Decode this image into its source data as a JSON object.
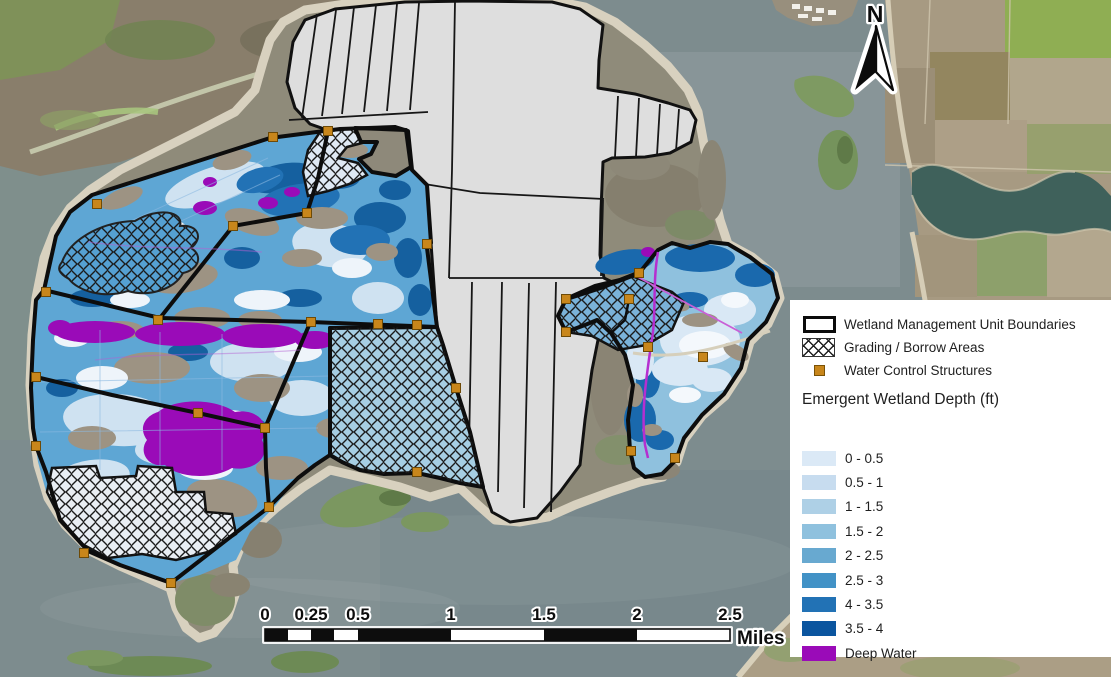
{
  "north_arrow": {
    "label": "N"
  },
  "scale_bar": {
    "tick_labels": [
      "0",
      "0.25",
      "0.5",
      "1",
      "1.5",
      "2",
      "2.5"
    ],
    "unit_label": "Miles"
  },
  "legend": {
    "items": [
      {
        "id": "boundary",
        "label": "Wetland Management Unit Boundaries"
      },
      {
        "id": "hatch",
        "label": "Grading / Borrow Areas"
      },
      {
        "id": "structure",
        "label": "Water Control Structures"
      }
    ],
    "depth_section_title": "Emergent Wetland Depth (ft)",
    "depth_classes": [
      {
        "label": "0 - 0.5",
        "color": "#dbe9f6"
      },
      {
        "label": "0.5 - 1",
        "color": "#c7dcef"
      },
      {
        "label": "1 - 1.5",
        "color": "#aed0e6"
      },
      {
        "label": "1.5 - 2",
        "color": "#8fc1de"
      },
      {
        "label": "2 - 2.5",
        "color": "#68a9d0"
      },
      {
        "label": "2.5 - 3",
        "color": "#4292c6"
      },
      {
        "label": "4 - 3.5",
        "color": "#2272b5"
      },
      {
        "label": "3.5 - 4",
        "color": "#0b559f"
      },
      {
        "label": "Deep Water",
        "color": "#9a0bb8"
      }
    ]
  },
  "map_colors": {
    "open_water": "#7d8c8e",
    "unit_boundary": "#0d0d0d",
    "gray_unit_fill": "#dedede",
    "structure_fill": "#c8861b",
    "structure_stroke": "#6e4a06",
    "deep_water": "#9a0bb8",
    "channel_line": "#b52fd0",
    "shoreline": "#d8d1bf"
  }
}
